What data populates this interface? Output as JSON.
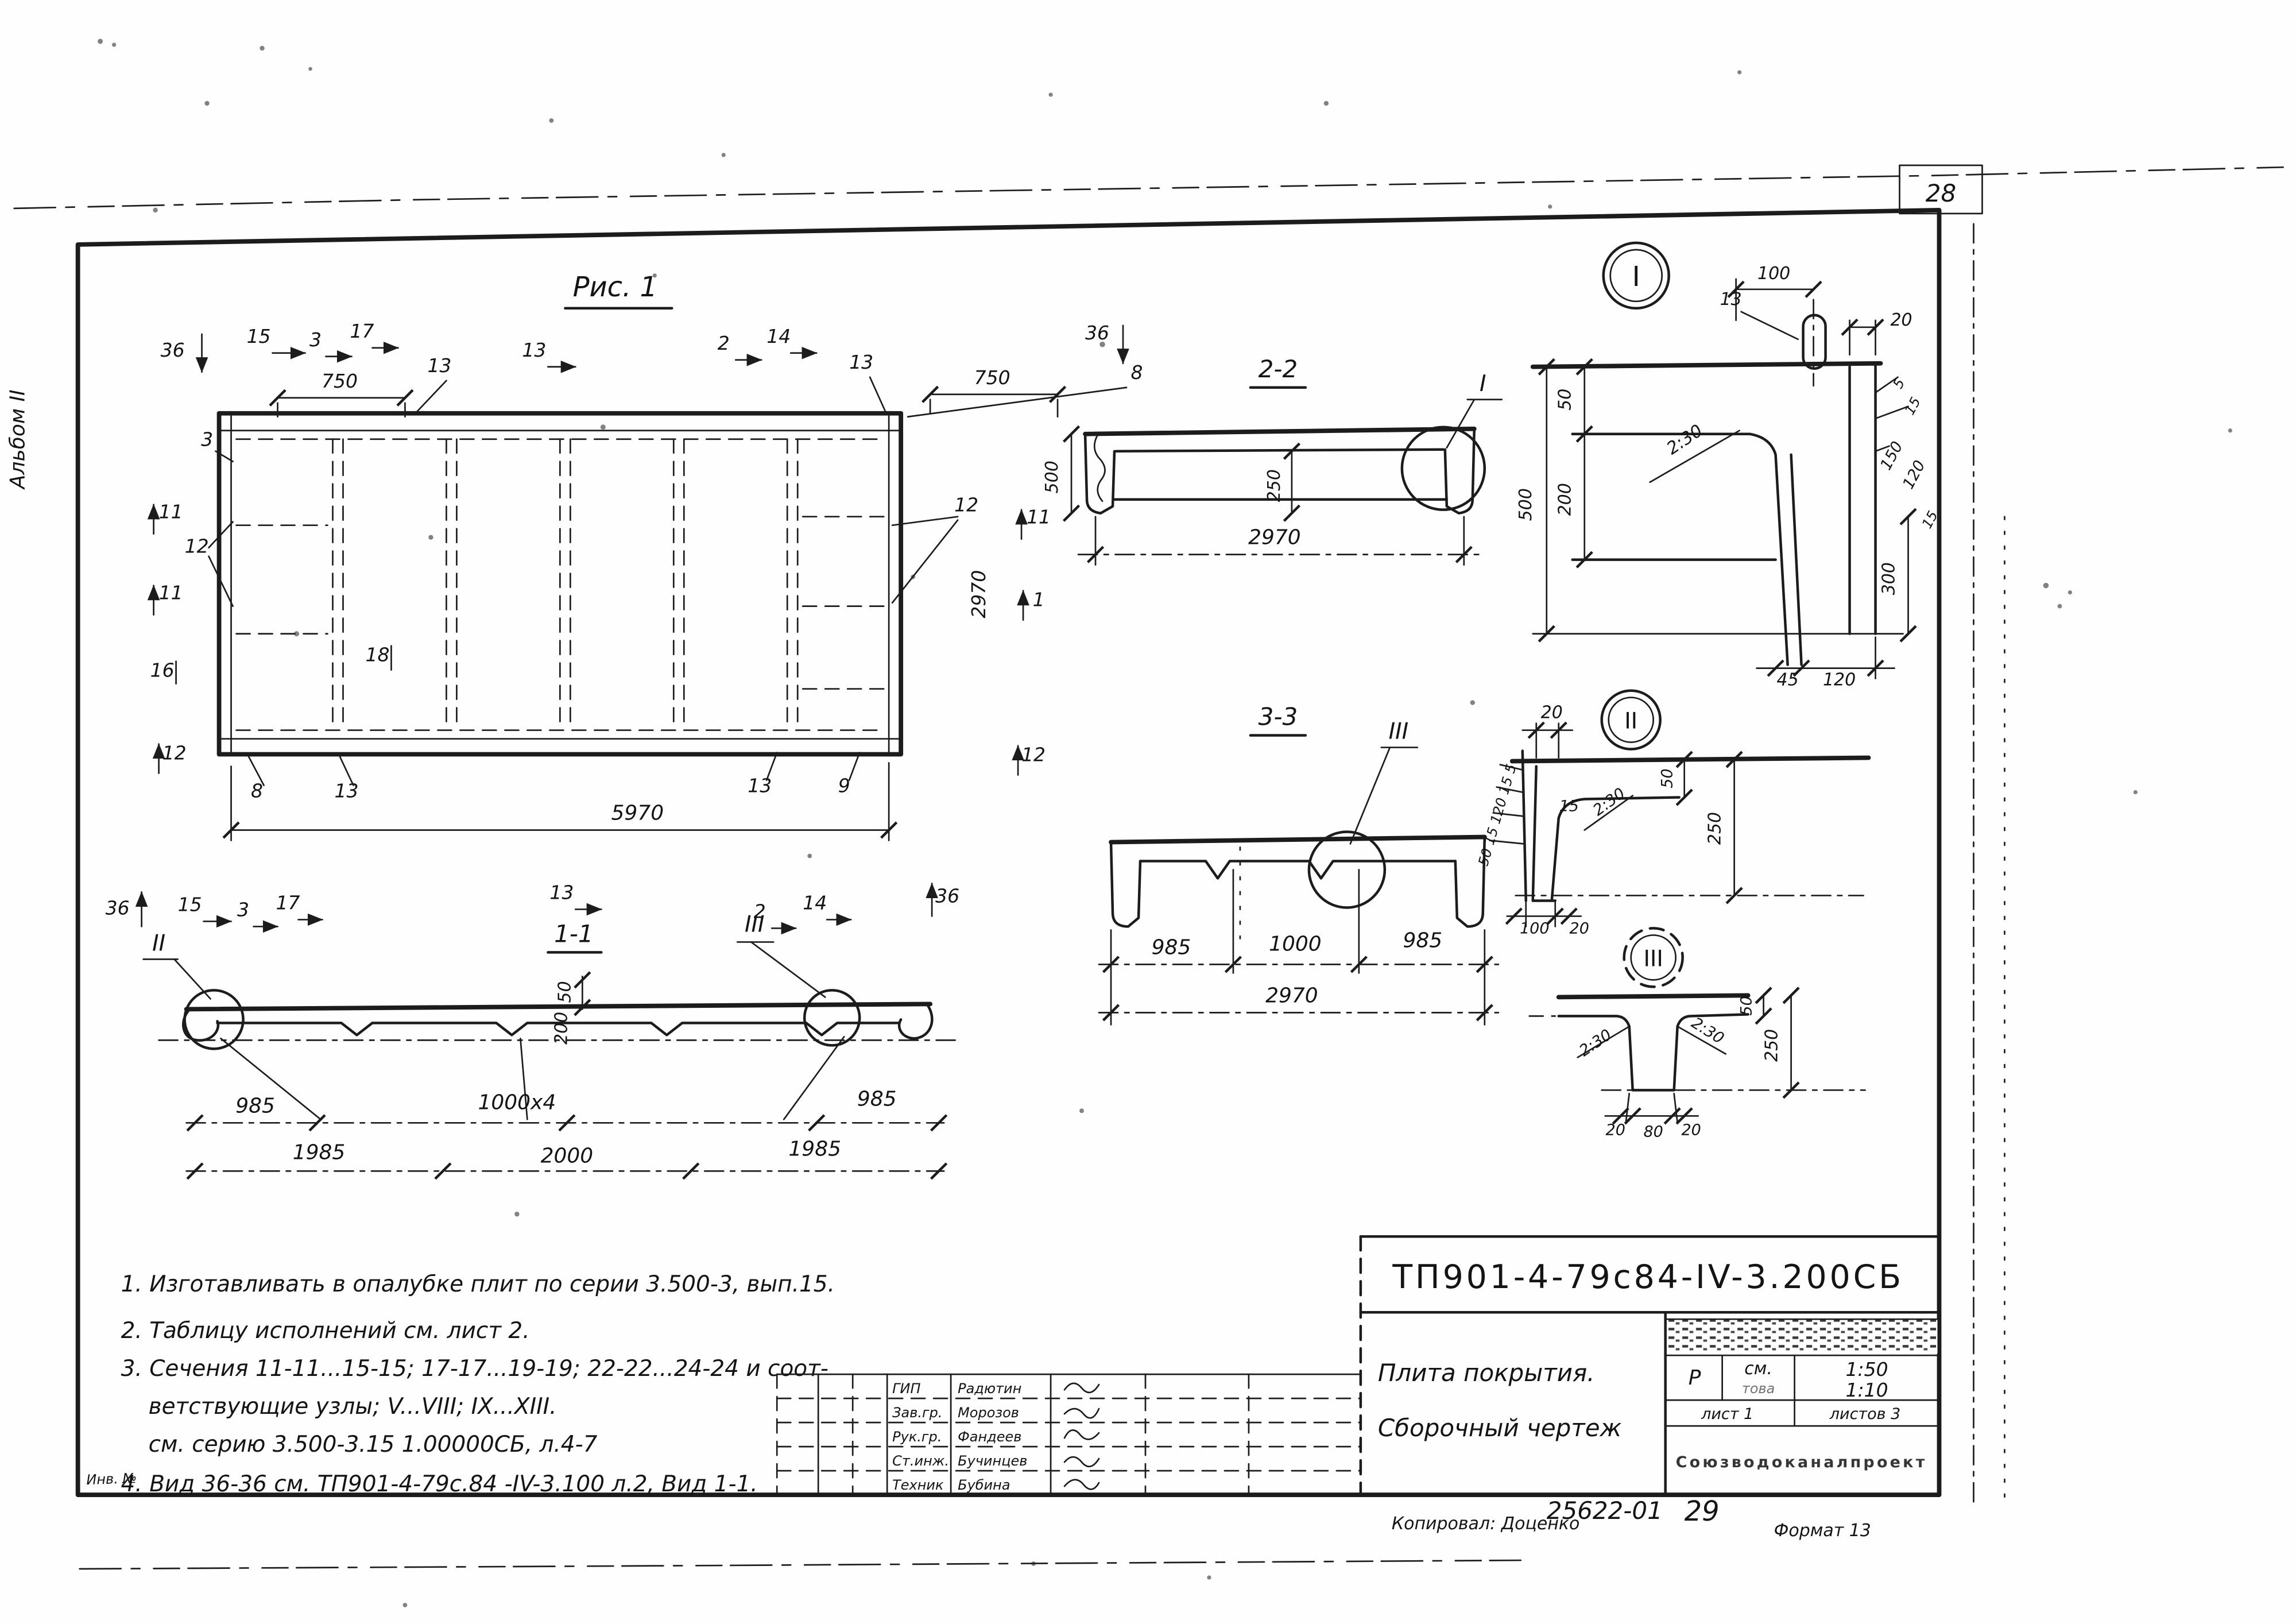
{
  "page": {
    "sheet_number_top": "28",
    "album_label": "Альбом II",
    "inv_label": "Инв. №"
  },
  "figure1": {
    "title": "Рис. 1",
    "dim_750": "750",
    "dim_5970": "5970",
    "dim_2970": "2970",
    "marks": {
      "m1": "1",
      "m2": "2",
      "m3": "3",
      "m8": "8",
      "m9": "9",
      "m11": "11",
      "m12": "12",
      "m13": "13",
      "m14": "14",
      "m15": "15",
      "m16": "16",
      "m17": "17",
      "m18": "18",
      "m36": "36"
    }
  },
  "section_1_1": {
    "title": "1-1",
    "callout_left": "II",
    "callout_right": "III",
    "dim_50": "50",
    "dim_200": "200",
    "dim_985": "985",
    "dim_1000x4": "1000х4",
    "dim_1985": "1985",
    "dim_2000": "2000"
  },
  "section_2_2": {
    "title": "2-2",
    "callout": "I",
    "dim_500": "500",
    "dim_250": "250",
    "dim_2970": "2970"
  },
  "section_3_3": {
    "title": "3-3",
    "callout": "III",
    "dim_985": "985",
    "dim_1000": "1000",
    "dim_2970": "2970"
  },
  "detail_I": {
    "title": "I",
    "dim_100": "100",
    "pos_13": "13",
    "dim_20": "20",
    "dim_50": "50",
    "dim_200": "200",
    "dim_500": "500",
    "slope": "2:30",
    "dim_5": "5",
    "dim_15": "15",
    "dim_150": "150",
    "dim_120": "120",
    "dim_300": "300",
    "dim_45": "45"
  },
  "detail_II": {
    "title": "II",
    "dim_20_top": "20",
    "left_stack": "50 15 120 15 5",
    "dim_15": "15",
    "slope": "2:30",
    "dim_50": "50",
    "dim_250": "250",
    "dim_100": "100",
    "dim_20_bottom": "20"
  },
  "detail_III": {
    "title": "III",
    "dim_50": "50",
    "dim_250": "250",
    "slope_left": "2:30",
    "slope_right": "2:30",
    "dim_20_left": "20",
    "dim_80": "80",
    "dim_20_right": "20"
  },
  "notes": {
    "line1": "1. Изготавливать в опалубке плит по серии 3.500-3, вып.15.",
    "line2": "2. Таблицу исполнений см. лист 2.",
    "line3": "3. Сечения 11-11...15-15; 17-17...19-19; 22-22...24-24 и соот-",
    "line4": "ветствующие узлы; V...VIII; IX...XIII.",
    "line5": "см. серию 3.500-3.15 1.00000СБ, л.4-7",
    "line6": "4. Вид 36-36 см. ТП901-4-79с.84 -IV-3.100 л.2, Вид 1-1."
  },
  "title_block": {
    "designation": "ТП901-4-79с84-IV-3.200СБ",
    "name_line1": "Плита покрытия.",
    "name_line2": "Сборочный чертеж",
    "stage": "Р",
    "scale_note": "см.",
    "scale_note2": "това",
    "scale_1": "1:50",
    "scale_2": "1:10",
    "sheet_cell": "лист 1",
    "sheets_cell": "листов 3",
    "organization": "Союзводоканалпроект"
  },
  "signatures": {
    "rows": [
      {
        "role": "ГИП",
        "name": "Радютин"
      },
      {
        "role": "Зав.гр.",
        "name": "Морозов"
      },
      {
        "role": "Рук.гр.",
        "name": "Фандеев"
      },
      {
        "role": "Ст.инж.",
        "name": "Бучинцев"
      },
      {
        "role": "Техник",
        "name": "Бубина"
      }
    ]
  },
  "footer": {
    "copied_by": "Копировал: Доценко",
    "order_number": "25622-01",
    "page_number": "29",
    "format": "Формат 13"
  }
}
